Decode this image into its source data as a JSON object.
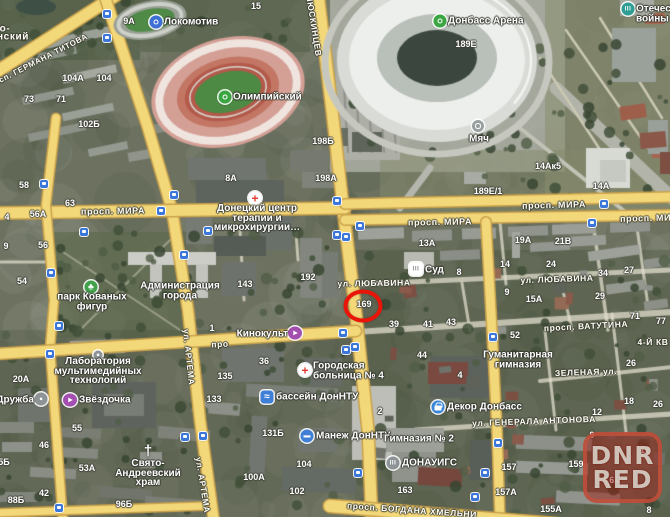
{
  "map": {
    "watermark": {
      "x": 583,
      "y": 432,
      "lines": [
        "DNR",
        "RED"
      ]
    },
    "annotation_circle": {
      "x": 363,
      "y": 306,
      "color": "#ea1508",
      "encircled_number": "169"
    },
    "accent_colors": {
      "road_yellow": "#f3d87a",
      "transit_blue": "#3b76d9",
      "poi_green": "#3aa642",
      "poi_purple": "#a34fb0",
      "poi_blue": "#3f7fd6",
      "hospital_red": "#e23b2e",
      "museum_teal": "#2e9d93"
    },
    "street_labels": [
      {
        "t": "просп. ГЕРМАНА ТИТОВА",
        "x": 36,
        "y": 62,
        "r": -27,
        "fs": 8
      },
      {
        "t": "ЛЮСКИНЦЕВ",
        "x": 314,
        "y": 26,
        "r": 81,
        "fs": 8.5
      },
      {
        "t": "просп. МИРА",
        "x": 113,
        "y": 211,
        "r": -1,
        "fs": 9
      },
      {
        "t": "просп. МИРА",
        "x": 554,
        "y": 205,
        "r": -1.5,
        "fs": 9
      },
      {
        "t": "просп. МИРА",
        "x": 440,
        "y": 222,
        "r": -1,
        "fs": 9
      },
      {
        "t": "просп. МИРА",
        "x": 652,
        "y": 218,
        "r": -1.5,
        "fs": 9
      },
      {
        "t": "ул. ЛЮБАВИНА",
        "x": 374,
        "y": 283,
        "r": -1,
        "fs": 8.5
      },
      {
        "t": "ул. ЛЮБАВИНА",
        "x": 557,
        "y": 279,
        "r": -2,
        "fs": 8.5
      },
      {
        "t": "просп. ВАТУТИНА",
        "x": 586,
        "y": 326,
        "r": -3,
        "fs": 8.5
      },
      {
        "t": "ЗЕЛЕНАЯ ул.",
        "x": 586,
        "y": 372,
        "r": -2,
        "fs": 8.5
      },
      {
        "t": "ул. ГЕНЕРАЛА АНТОНОВА",
        "x": 534,
        "y": 421,
        "r": -2,
        "fs": 8.5
      },
      {
        "t": "просп. БОГДАНА ХМЕЛЬНИ",
        "x": 412,
        "y": 510,
        "r": 4,
        "fs": 8.5
      },
      {
        "t": "ул. АРТЕМА",
        "x": 189,
        "y": 357,
        "r": 84,
        "fs": 8.5
      },
      {
        "t": "ул. АРТЕМА",
        "x": 203,
        "y": 485,
        "r": 81,
        "fs": 8.5
      },
      {
        "t": "4-Й КВ",
        "x": 653,
        "y": 342,
        "r": 0,
        "fs": 8.5
      },
      {
        "t": "про",
        "x": 220,
        "y": 344,
        "r": -3,
        "fs": 8.5
      },
      {
        "t": "о-",
        "x": 5,
        "y": 29,
        "r": 0,
        "fs": 10
      },
      {
        "t": "нский",
        "x": 13,
        "y": 37,
        "r": 0,
        "fs": 10
      }
    ],
    "house_numbers": [
      {
        "t": "15",
        "x": 256,
        "y": 6
      },
      {
        "t": "9А",
        "x": 129,
        "y": 21
      },
      {
        "t": "104А",
        "x": 73,
        "y": 78
      },
      {
        "t": "104",
        "x": 104,
        "y": 78
      },
      {
        "t": "73",
        "x": 29,
        "y": 99
      },
      {
        "t": "71",
        "x": 61,
        "y": 99
      },
      {
        "t": "102Б",
        "x": 89,
        "y": 124
      },
      {
        "t": "189Е",
        "x": 466,
        "y": 44
      },
      {
        "t": "198Б",
        "x": 323,
        "y": 141
      },
      {
        "t": "8А",
        "x": 231,
        "y": 178
      },
      {
        "t": "198А",
        "x": 326,
        "y": 178
      },
      {
        "t": "14Ак5",
        "x": 548,
        "y": 166
      },
      {
        "t": "14А",
        "x": 601,
        "y": 186
      },
      {
        "t": "189Е/1",
        "x": 488,
        "y": 191
      },
      {
        "t": "58",
        "x": 24,
        "y": 185
      },
      {
        "t": "63",
        "x": 70,
        "y": 203
      },
      {
        "t": "56А",
        "x": 38,
        "y": 214
      },
      {
        "t": "4",
        "x": 7,
        "y": 217
      },
      {
        "t": "9",
        "x": 6,
        "y": 246
      },
      {
        "t": "56",
        "x": 43,
        "y": 245
      },
      {
        "t": "54",
        "x": 22,
        "y": 281
      },
      {
        "t": "13А",
        "x": 427,
        "y": 243
      },
      {
        "t": "19А",
        "x": 523,
        "y": 240
      },
      {
        "t": "21В",
        "x": 563,
        "y": 241
      },
      {
        "t": "14",
        "x": 505,
        "y": 264
      },
      {
        "t": "24",
        "x": 551,
        "y": 264
      },
      {
        "t": "34",
        "x": 603,
        "y": 273
      },
      {
        "t": "27",
        "x": 629,
        "y": 270
      },
      {
        "t": "8",
        "x": 459,
        "y": 272
      },
      {
        "t": "143",
        "x": 245,
        "y": 284
      },
      {
        "t": "192",
        "x": 308,
        "y": 277
      },
      {
        "t": "169",
        "x": 364,
        "y": 304
      },
      {
        "t": "29",
        "x": 600,
        "y": 296
      },
      {
        "t": "9",
        "x": 507,
        "y": 292
      },
      {
        "t": "15А",
        "x": 534,
        "y": 299
      },
      {
        "t": "39",
        "x": 394,
        "y": 324
      },
      {
        "t": "41",
        "x": 428,
        "y": 324
      },
      {
        "t": "43",
        "x": 451,
        "y": 322
      },
      {
        "t": "71",
        "x": 635,
        "y": 316
      },
      {
        "t": "77",
        "x": 661,
        "y": 321
      },
      {
        "t": "1",
        "x": 212,
        "y": 328
      },
      {
        "t": "44",
        "x": 422,
        "y": 355
      },
      {
        "t": "4",
        "x": 460,
        "y": 375
      },
      {
        "t": "52",
        "x": 515,
        "y": 335
      },
      {
        "t": "26",
        "x": 631,
        "y": 363
      },
      {
        "t": "36",
        "x": 264,
        "y": 361
      },
      {
        "t": "135",
        "x": 225,
        "y": 376
      },
      {
        "t": "133",
        "x": 214,
        "y": 399
      },
      {
        "t": "20А",
        "x": 21,
        "y": 379
      },
      {
        "t": "55",
        "x": 77,
        "y": 428
      },
      {
        "t": "46",
        "x": 44,
        "y": 445
      },
      {
        "t": "5Б",
        "x": 4,
        "y": 462
      },
      {
        "t": "53А",
        "x": 87,
        "y": 468
      },
      {
        "t": "42",
        "x": 44,
        "y": 493
      },
      {
        "t": "88Б",
        "x": 16,
        "y": 500
      },
      {
        "t": "96Б",
        "x": 124,
        "y": 504
      },
      {
        "t": "131Б",
        "x": 273,
        "y": 433
      },
      {
        "t": "104",
        "x": 304,
        "y": 464
      },
      {
        "t": "100А",
        "x": 254,
        "y": 477
      },
      {
        "t": "102",
        "x": 297,
        "y": 491
      },
      {
        "t": "2",
        "x": 380,
        "y": 411
      },
      {
        "t": "12",
        "x": 597,
        "y": 412
      },
      {
        "t": "18",
        "x": 629,
        "y": 401
      },
      {
        "t": "26",
        "x": 658,
        "y": 404
      },
      {
        "t": "157",
        "x": 509,
        "y": 467
      },
      {
        "t": "157А",
        "x": 506,
        "y": 492
      },
      {
        "t": "155А",
        "x": 551,
        "y": 509
      },
      {
        "t": "163",
        "x": 405,
        "y": 490
      },
      {
        "t": "159",
        "x": 576,
        "y": 464
      },
      {
        "t": "9",
        "x": 592,
        "y": 435
      },
      {
        "t": "16",
        "x": 645,
        "y": 450
      },
      {
        "t": "6А",
        "x": 615,
        "y": 480
      },
      {
        "t": "8",
        "x": 649,
        "y": 510
      }
    ],
    "pois": [
      {
        "key": "lokomotiv-stadium",
        "text": "Локомотив",
        "tx": 164,
        "ty": 22,
        "anchor": "left",
        "icon": {
          "kind": "ring",
          "color": "#3d6fd4",
          "x": 156,
          "y": 22
        }
      },
      {
        "key": "olimpiysky-stadium",
        "text": "Олимпийский",
        "tx": 233,
        "ty": 97,
        "anchor": "left",
        "icon": {
          "kind": "ring",
          "color": "#3aa642",
          "x": 225,
          "y": 97
        }
      },
      {
        "key": "donbass-arena",
        "text": "Донбасс Арена",
        "tx": 448,
        "ty": 21,
        "anchor": "left",
        "icon": {
          "kind": "ring",
          "color": "#3aa642",
          "x": 440,
          "y": 21
        }
      },
      {
        "key": "myach-monument",
        "text": "Мяч",
        "tx": 479,
        "ty": 139,
        "anchor": "center",
        "icon": {
          "kind": "ring",
          "color": "#98a0a0",
          "x": 478,
          "y": 126,
          "size": 12
        }
      },
      {
        "key": "museum-otechestvennoy-voyny",
        "text": "Отечественной\nвойны",
        "tx": 636,
        "ty": 14,
        "anchor": "left",
        "icon": {
          "kind": "bars",
          "color": "#2e9d93",
          "x": 628,
          "y": 9
        }
      },
      {
        "key": "donetsk-center-terapii-mikrohirurgii",
        "text": "Донецкий центр\nтерапии и\nмикрохирургии…",
        "tx": 257,
        "ty": 218,
        "anchor": "center",
        "icon": {
          "kind": "cross",
          "color": "#ffffff",
          "x": 255,
          "y": 198
        }
      },
      {
        "key": "gorodskaya-bolnitsa-4",
        "text": "Городская\nбольница № 4",
        "tx": 313,
        "ty": 371,
        "anchor": "left",
        "icon": {
          "kind": "cross",
          "color": "#ffffff",
          "x": 305,
          "y": 370
        }
      },
      {
        "key": "park-kovanyh-figur",
        "text": "парк Кованых\nфигур",
        "tx": 92,
        "ty": 302,
        "anchor": "center",
        "icon": {
          "kind": "tree",
          "color": "#41a04a",
          "x": 91,
          "y": 287
        }
      },
      {
        "key": "administratsiya-goroda",
        "text": "Администрация\nгорода",
        "tx": 180,
        "ty": 291,
        "anchor": "center",
        "icon": null
      },
      {
        "key": "sud",
        "text": "Суд",
        "tx": 425,
        "ty": 270,
        "anchor": "left",
        "icon": {
          "kind": "court",
          "color": "#ffffff",
          "x": 416,
          "y": 269
        }
      },
      {
        "key": "kinokult",
        "text": "Кинокульт",
        "tx": 288,
        "ty": 334,
        "anchor": "right",
        "icon": {
          "kind": "cinema",
          "color": "#a34fb0",
          "x": 295,
          "y": 333
        }
      },
      {
        "key": "zvezdochka",
        "text": "Звёздочка",
        "tx": 79,
        "ty": 400,
        "anchor": "left",
        "icon": {
          "kind": "cinema",
          "color": "#a34fb0",
          "x": 70,
          "y": 400
        }
      },
      {
        "key": "druzhba",
        "text": "Дружба",
        "tx": 34,
        "ty": 400,
        "anchor": "right",
        "icon": {
          "kind": "dot",
          "color": "#8e9496",
          "x": 41,
          "y": 399
        }
      },
      {
        "key": "laboratoriya-multimedia",
        "text": "Лаборатория\nмультимедийных\nтехнологий",
        "tx": 98,
        "ty": 371,
        "anchor": "center",
        "icon": {
          "kind": "dot",
          "color": "#8e9496",
          "x": 98,
          "y": 355,
          "size": 9
        }
      },
      {
        "key": "bassein-donntu",
        "text": "бассейн ДонНТУ",
        "tx": 276,
        "ty": 397,
        "anchor": "left",
        "icon": {
          "kind": "pool",
          "color": "#3f7fd6",
          "x": 267,
          "y": 397
        }
      },
      {
        "key": "manezh-donntu",
        "text": "Манеж ДонНТУ",
        "tx": 316,
        "ty": 436,
        "anchor": "left",
        "icon": {
          "kind": "bar",
          "color": "#3f7fd6",
          "x": 307,
          "y": 436
        }
      },
      {
        "key": "svyato-andreevsky-hram",
        "text": "Свято-\nАндреевский\nхрам",
        "tx": 148,
        "ty": 473,
        "anchor": "center",
        "icon": {
          "kind": "church",
          "color": "",
          "x": 148,
          "y": 451
        }
      },
      {
        "key": "dekor-donbass",
        "text": "Декор Донбасс",
        "tx": 447,
        "ty": 407,
        "anchor": "left",
        "icon": {
          "kind": "bag",
          "color": "#3a86d8",
          "x": 438,
          "y": 407
        }
      },
      {
        "key": "donauigs",
        "text": "ДОНАУИГС",
        "tx": 402,
        "ty": 463,
        "anchor": "left",
        "icon": {
          "kind": "bars",
          "color": "#8e9496",
          "x": 393,
          "y": 463
        }
      },
      {
        "key": "gimnaziya-2",
        "text": "Гимназия № 2",
        "tx": 419,
        "ty": 439,
        "anchor": "center",
        "icon": null
      },
      {
        "key": "gumanitarnaya-gimnaziya",
        "text": "Гуманитарная\nгимназия",
        "tx": 518,
        "ty": 360,
        "anchor": "center",
        "icon": null
      }
    ],
    "transit_stops": [
      [
        107,
        14
      ],
      [
        107,
        38
      ],
      [
        44,
        184
      ],
      [
        174,
        195
      ],
      [
        161,
        211
      ],
      [
        84,
        232
      ],
      [
        208,
        231
      ],
      [
        184,
        255
      ],
      [
        51,
        273
      ],
      [
        59,
        326
      ],
      [
        337,
        201
      ],
      [
        360,
        226
      ],
      [
        337,
        235
      ],
      [
        346,
        237
      ],
      [
        604,
        204
      ],
      [
        592,
        223
      ],
      [
        343,
        333
      ],
      [
        346,
        350
      ],
      [
        355,
        347
      ],
      [
        50,
        354
      ],
      [
        185,
        437
      ],
      [
        203,
        436
      ],
      [
        59,
        508
      ],
      [
        493,
        337
      ],
      [
        498,
        443
      ],
      [
        485,
        473
      ],
      [
        475,
        497
      ],
      [
        358,
        473
      ]
    ]
  }
}
